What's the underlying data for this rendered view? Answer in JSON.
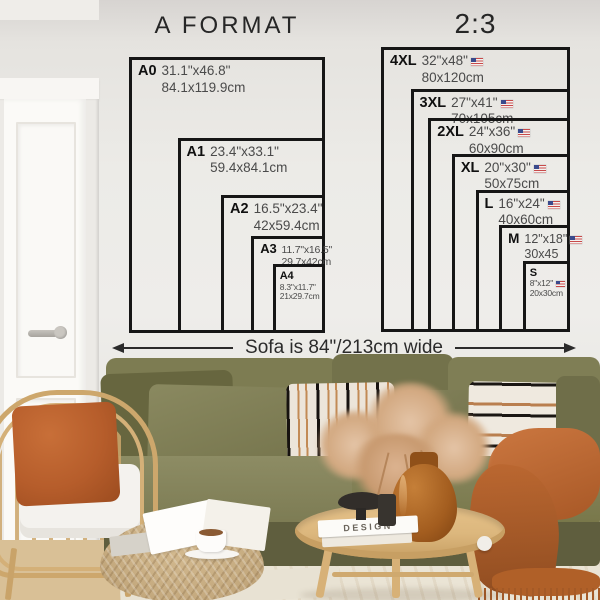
{
  "left_diagram": {
    "title": "A FORMAT",
    "sizes": [
      {
        "code": "A0",
        "inches": "31.1\"x46.8\"",
        "cm": "84.1x119.9cm",
        "w_in": 31.1,
        "h_in": 46.8,
        "flag": false,
        "tier": "lg",
        "stack": false
      },
      {
        "code": "A1",
        "inches": "23.4\"x33.1\"",
        "cm": "59.4x84.1cm",
        "w_in": 23.4,
        "h_in": 33.1,
        "flag": false,
        "tier": "lg",
        "stack": false
      },
      {
        "code": "A2",
        "inches": "16.5\"x23.4\"",
        "cm": "42x59.4cm",
        "w_in": 16.5,
        "h_in": 23.4,
        "flag": false,
        "tier": "lg",
        "stack": false
      },
      {
        "code": "A3",
        "inches": "11.7\"x16.5\"",
        "cm": "29.7x42cm",
        "w_in": 11.7,
        "h_in": 16.5,
        "flag": false,
        "tier": "sm",
        "stack": false
      },
      {
        "code": "A4",
        "inches": "8.3\"x11.7\"",
        "cm": "21x29.7cm",
        "w_in": 8.3,
        "h_in": 11.7,
        "flag": false,
        "tier": "xs",
        "stack": true
      }
    ]
  },
  "right_diagram": {
    "title": "2:3",
    "sizes": [
      {
        "code": "4XL",
        "inches": "32\"x48\"",
        "cm": "80x120cm",
        "w_in": 32,
        "h_in": 48,
        "flag": true,
        "tier": "lg",
        "stack": false
      },
      {
        "code": "3XL",
        "inches": "27\"x41\"",
        "cm": "70x105cm",
        "w_in": 27,
        "h_in": 41,
        "flag": true,
        "tier": "lg",
        "stack": false
      },
      {
        "code": "2XL",
        "inches": "24\"x36\"",
        "cm": "60x90cm",
        "w_in": 24,
        "h_in": 36,
        "flag": true,
        "tier": "lg",
        "stack": false
      },
      {
        "code": "XL",
        "inches": "20\"x30\"",
        "cm": "50x75cm",
        "w_in": 20,
        "h_in": 30,
        "flag": true,
        "tier": "lg",
        "stack": false
      },
      {
        "code": "L",
        "inches": "16\"x24\"",
        "cm": "40x60cm",
        "w_in": 16,
        "h_in": 24,
        "flag": true,
        "tier": "lg",
        "stack": false
      },
      {
        "code": "M",
        "inches": "12\"x18\"",
        "cm": "30x45",
        "w_in": 12,
        "h_in": 18,
        "flag": true,
        "tier": "md",
        "stack": false
      },
      {
        "code": "S",
        "inches": "8\"x12\"",
        "cm": "20x30cm",
        "w_in": 8,
        "h_in": 12,
        "flag": true,
        "tier": "xs",
        "stack": true
      }
    ]
  },
  "sofa_label": {
    "text": "Sofa is 84\"/213cm wide"
  },
  "decor": {
    "book_spine": "DESIGN"
  },
  "colors": {
    "line": "#161616",
    "wall": "#e9e7e3",
    "sofa-olive": "#7b7a52",
    "sofa-dark": "#5f5e3e",
    "rust": "#b65d2b",
    "throw-orange": "#b96631",
    "rattan": "#cda76c",
    "table-wood": "#dcb77d",
    "rug": "#eae4d5",
    "floor-wood": "#d9c096",
    "flag-red": "#c84a4a",
    "flag-blue": "#3a4a8c"
  }
}
